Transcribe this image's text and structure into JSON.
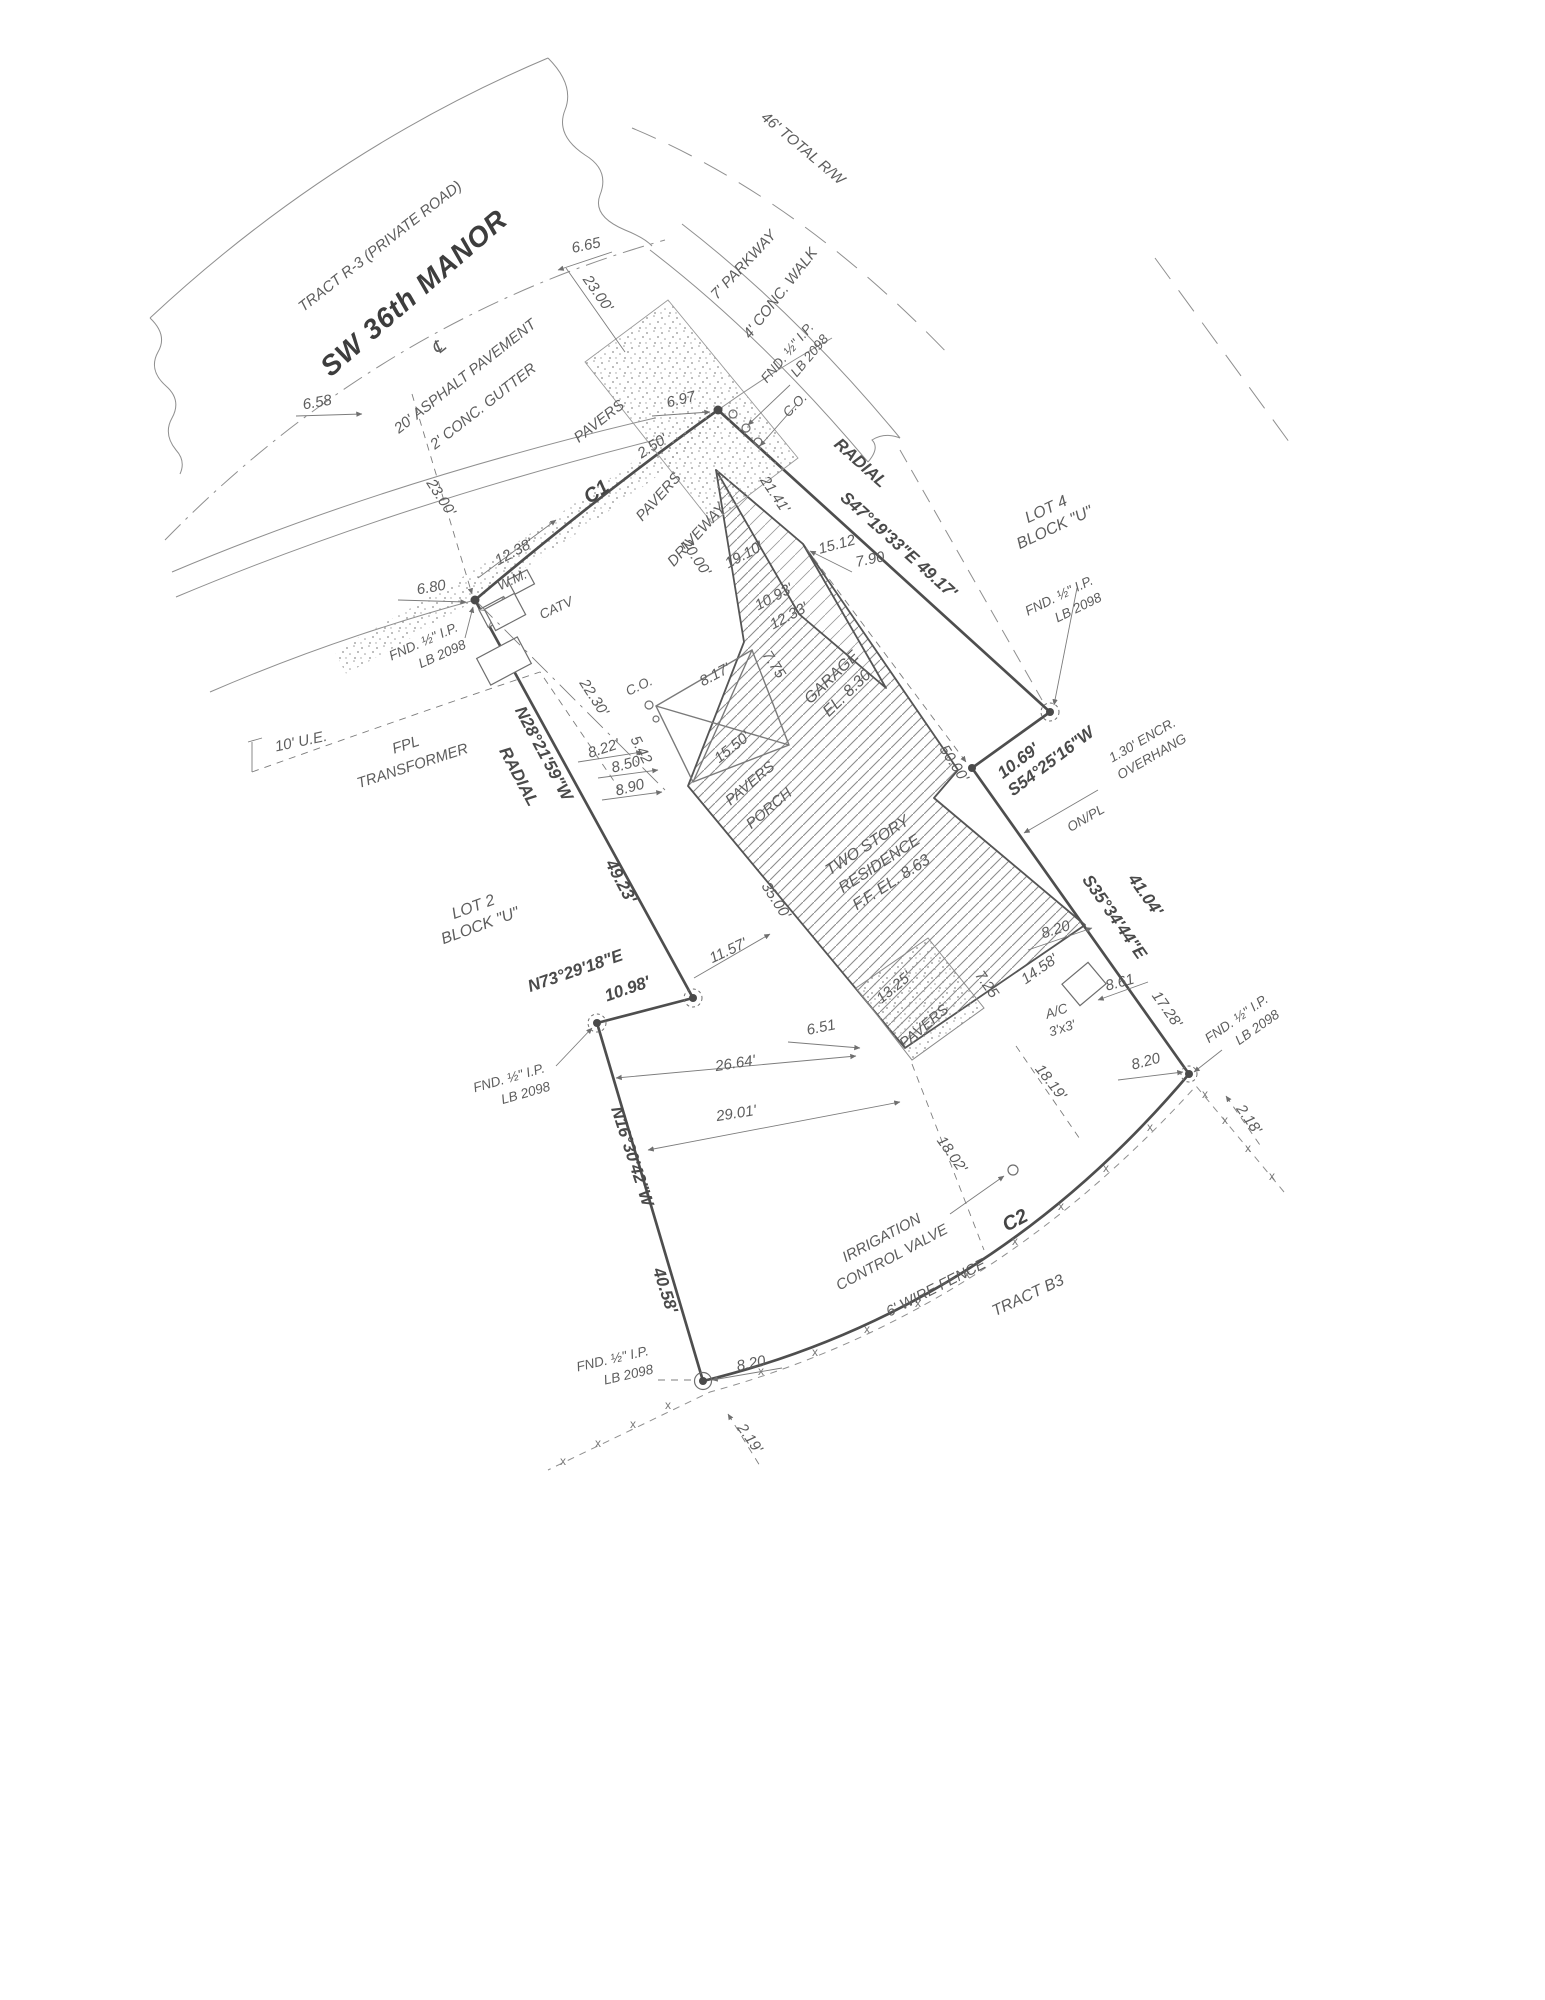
{
  "meta": {
    "type": "boundary-survey-plat",
    "paper": "#ffffff",
    "ink": "#4c4c4c"
  },
  "street": {
    "tract": "TRACT R-3 (PRIVATE ROAD)",
    "name": "SW 36th MANOR",
    "total_rw": "46' TOTAL R/W",
    "asphalt": "20' ASPHALT PAVEMENT",
    "gutter": "2' CONC. GUTTER",
    "parkway": "7' PARKWAY",
    "walk": "4' CONC. WALK",
    "centerline_mark": "℄"
  },
  "boundary": {
    "c1": "C1",
    "c2": "C2",
    "radial": "RADIAL",
    "s47": "S47°19'33\"E  49.17'",
    "n28": "N28°21'59\"W",
    "n28_len": "49.23'",
    "s54_len": "10.69'",
    "s54": "S54°25'16\"W",
    "s35": "S35°34'44\"E",
    "s35_len": "41.04'",
    "n73": "N73°29'18\"E",
    "n73_len": "10.98'",
    "n16": "N16°30'42\"W",
    "n16_len": "40.58'"
  },
  "lots": {
    "lot2": "LOT 2",
    "lot4": "LOT 4",
    "block_u": "BLOCK \"U\"",
    "tract_b3": "TRACT B3"
  },
  "monument": {
    "fnd": "FND. ½\" I.P.",
    "lb": "LB 2098"
  },
  "features": {
    "pavers": "PAVERS",
    "driveway": "DRIVEWAY",
    "porch": "PORCH",
    "garage": "GARAGE",
    "garage_el": "EL. 8.30",
    "res1": "TWO STORY",
    "res2": "RESIDENCE",
    "res3": "F.F. EL. 8.63",
    "ac": "A/C",
    "ac_size": "3'x3'",
    "wm": "W.M.",
    "catv": "CATV",
    "co": "C.O.",
    "fpl1": "FPL",
    "fpl2": "TRANSFORMER",
    "ue": "10' U.E.",
    "icv1": "IRRIGATION",
    "icv2": "CONTROL VALVE",
    "fence": "6' WIRE FENCE",
    "encr": "1.30' ENCR.",
    "encr2": "OVERHANG",
    "onpl": "ON/PL"
  },
  "dims": {
    "d658": "6.58",
    "d665": "6.65",
    "d2300": "23.00'",
    "d680": "6.80",
    "d1238": "12.38'",
    "d697": "6.97",
    "d250": "2.50'",
    "d2141": "21.41'",
    "d2000": "20.00'",
    "d1910": "19.10'",
    "d1512": "15.12",
    "d790": "7.90",
    "d1093": "10.93'",
    "d1233": "12.33'",
    "d775": "7.75",
    "d817": "8.17'",
    "d2230": "22.30'",
    "d542": "5.42",
    "d822": "8.22'",
    "d850": "8.50",
    "d890": "8.90",
    "d1550": "15.50'",
    "d3500": "35.00'",
    "d5000": "50.00'",
    "d1157": "11.57'",
    "d651": "6.51",
    "d1325": "13.25'",
    "d725": "7.25",
    "d1458": "14.58'",
    "d820": "8.20",
    "d861": "8.61",
    "d1728": "17.28'",
    "d1819": "18.19'",
    "d1802": "18.02'",
    "d2664": "26.64'",
    "d2901": "29.01'",
    "d218": "2.18'",
    "d219": "2.19'"
  },
  "marks": {
    "fence_x": "x"
  }
}
